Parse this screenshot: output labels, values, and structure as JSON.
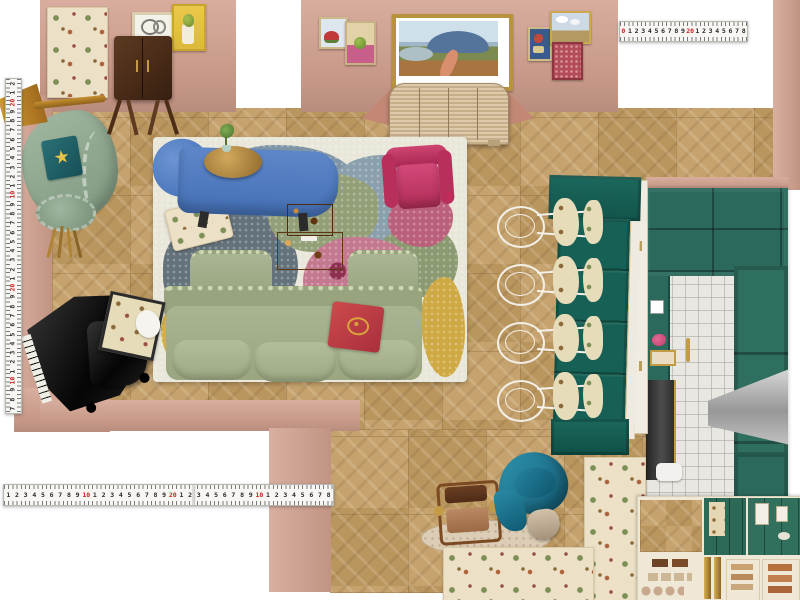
{
  "app": {
    "name": "Interior design floor-plan moodboard"
  },
  "icons": {
    "starfish_glyph": "★"
  },
  "palette": {
    "wall": "#d2a08e",
    "wall_shadow": "#c28875",
    "floor": "#c39e66",
    "rug_base": "#e9e6da",
    "sofa_green": "#a9b392",
    "settee_green": "#94ac97",
    "chaise_blue": "#4e7dc4",
    "armchair_magenta": "#c23a64",
    "pillow_red": "#c04446",
    "banquette_teal": "#176055",
    "kitchen_teal": "#2b695d",
    "brass": "#b08435",
    "burl": "#c07b2e",
    "travertine": "#dccdb6",
    "cream": "#efe8d6",
    "tape_red": "#cc2222"
  },
  "rulers": {
    "top": {
      "unit_numbers": [
        "0",
        "1",
        "2",
        "3",
        "4",
        "5",
        "6",
        "7",
        "8",
        "9",
        "20",
        "1",
        "2",
        "3",
        "4",
        "5",
        "6",
        "7",
        "8"
      ],
      "red_numbers": [
        "0",
        "10",
        "20"
      ]
    },
    "left": {
      "unit_numbers": [
        "2",
        "1",
        "20",
        "9",
        "8",
        "7",
        "6",
        "5",
        "4",
        "3",
        "2",
        "1",
        "10",
        "9",
        "8",
        "7",
        "6",
        "5",
        "4",
        "3",
        "2",
        "1",
        "20",
        "9",
        "8",
        "7",
        "6",
        "5",
        "4",
        "3",
        "2",
        "1",
        "10",
        "9",
        "8",
        "7"
      ],
      "red_numbers": [
        "10",
        "20"
      ]
    },
    "bottom": {
      "unit_numbers": [
        "1",
        "2",
        "3",
        "4",
        "5",
        "6",
        "7",
        "8",
        "9",
        "10",
        "1",
        "2",
        "3",
        "4",
        "5",
        "6",
        "7",
        "8",
        "9",
        "20",
        "1",
        "2",
        "3",
        "4",
        "5",
        "6",
        "7",
        "8",
        "9",
        "10",
        "1",
        "2",
        "3",
        "4",
        "5",
        "6",
        "7",
        "8"
      ],
      "red_numbers": [
        "10",
        "20"
      ]
    }
  },
  "scene": {
    "areas": [
      "living-room",
      "dining-banquette",
      "kitchen"
    ],
    "furniture": [
      "bar-cabinet",
      "floor-lamp",
      "curved-settee",
      "blue-chaise-lounge",
      "brass-side-table",
      "pink-armchair",
      "burl-coffee-table",
      "sage-velvet-sofa",
      "grand-piano",
      "piano-bench",
      "banquette-bench",
      "wire-dining-chairs",
      "kitchen-range",
      "range-hood",
      "safari-chair",
      "teal-swivel-chair",
      "travertine-oval-table",
      "reeded-credenza",
      "toaster"
    ],
    "artwork": [
      "framed-sketch",
      "pear-still-life",
      "watermelon-still-life",
      "fruit-still-life",
      "coastal-landscape-painting",
      "gallery-cluster"
    ],
    "textiles": [
      "chinoiserie-rug-samples",
      "abstract-area-rug",
      "tapestry-swatch",
      "starfish-pillow",
      "red-crest-pillow"
    ]
  }
}
